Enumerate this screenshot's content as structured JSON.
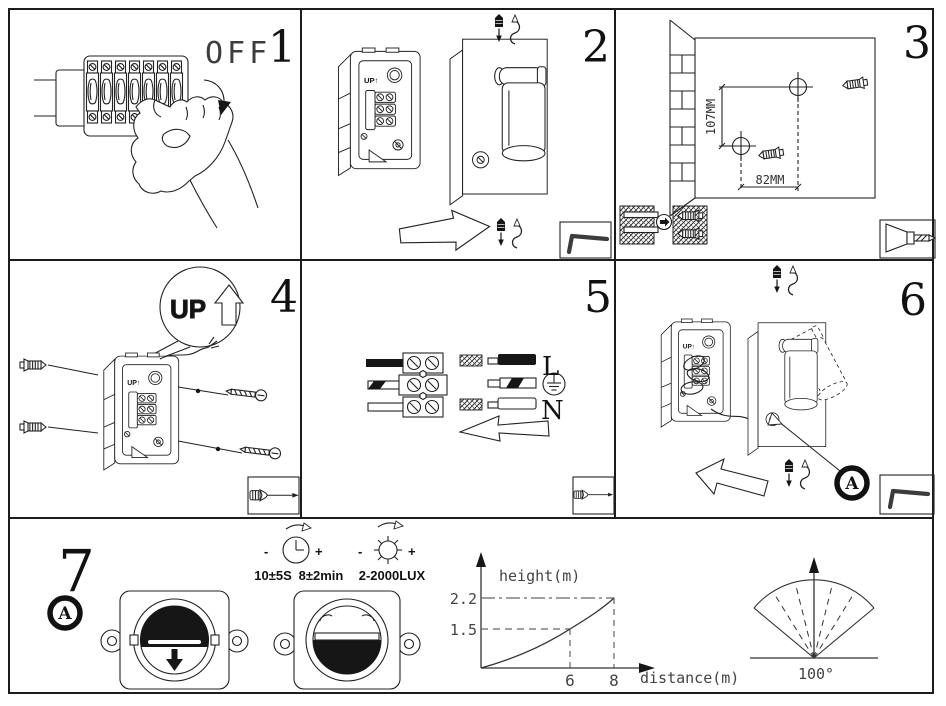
{
  "shared": {
    "box_marking": "UP↑"
  },
  "panels": {
    "step1": {
      "number": "1",
      "off_label": "OFF"
    },
    "step2": {
      "number": "2"
    },
    "step3": {
      "number": "3",
      "dim_vertical": "107MM",
      "dim_horizontal": "82MM"
    },
    "step4": {
      "number": "4",
      "up_callout": "UP"
    },
    "step5": {
      "number": "5",
      "live_label": "L",
      "neutral_label": "N"
    },
    "step6": {
      "number": "6",
      "detail_ref": "A"
    },
    "step7": {
      "number": "7",
      "detail_ref": "A",
      "minus": "-",
      "plus": "+",
      "time_on_spec": "10±5S",
      "time_delay_spec": "8±2min",
      "lux_spec": "2-2000LUX",
      "angle_label": "100°"
    }
  },
  "chart_data": {
    "type": "line",
    "title": "",
    "xlabel": "distance(m)",
    "ylabel": "height(m)",
    "x": [
      0,
      6,
      8
    ],
    "y": [
      0,
      1.5,
      2.2
    ],
    "x_tick_labels": [
      "6",
      "8"
    ],
    "y_tick_labels": [
      "2.2",
      "1.5"
    ],
    "xlim": [
      0,
      9
    ],
    "ylim": [
      0,
      2.8
    ],
    "notes": "mounting height vs detection distance; dashed guides at (6,1.5) and (8,2.2); grid off"
  }
}
